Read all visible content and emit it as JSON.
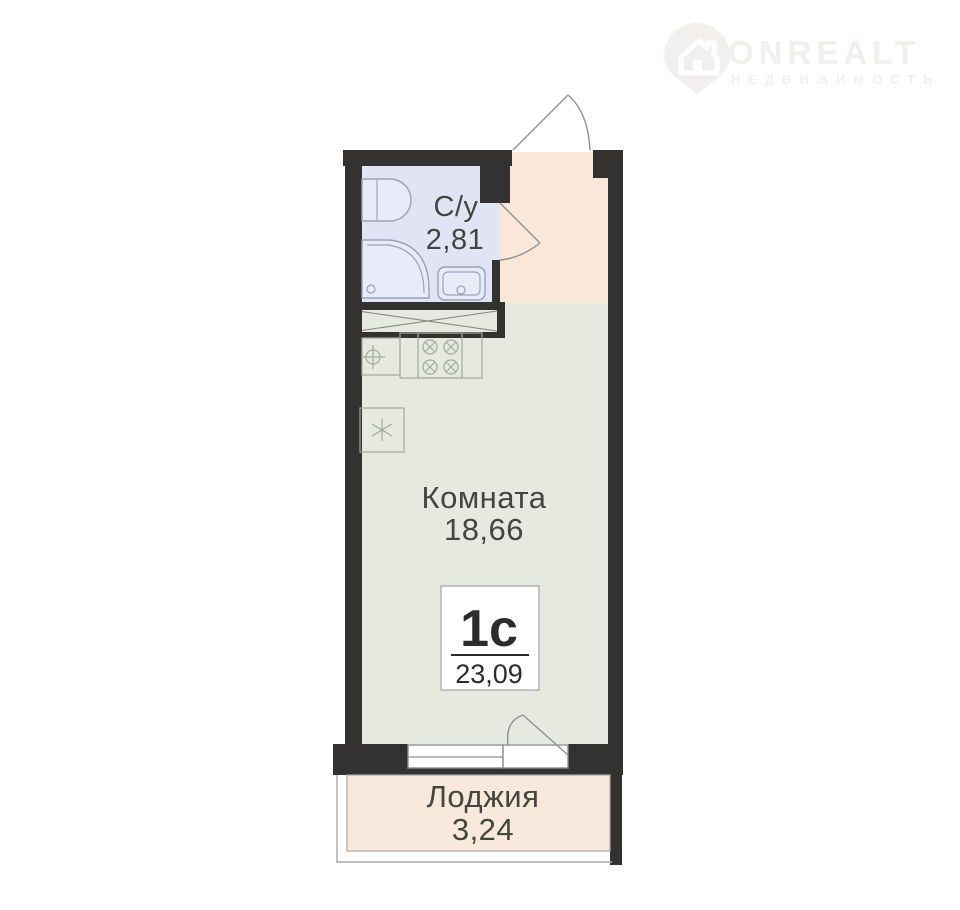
{
  "logo": {
    "brand": "ONREALT",
    "tagline": "НЕДВИЖИМОСТЬ"
  },
  "rooms": {
    "bathroom": {
      "label": "С/у",
      "area": "2,81"
    },
    "room": {
      "label": "Комната",
      "area": "18,66"
    },
    "loggia": {
      "label": "Лоджия",
      "area": "3,24"
    }
  },
  "badge": {
    "type": "1с",
    "total_area": "23,09"
  },
  "colors": {
    "wall": "#343230",
    "bathroom_floor": "#e0e4f4",
    "hallway_floor": "#f9e8da",
    "room_floor": "#e5e9df",
    "loggia_floor": "#f8e9dc",
    "label_text": "#42463f",
    "badge_text": "#2c2c2c",
    "logo": "#f1f0ee"
  }
}
